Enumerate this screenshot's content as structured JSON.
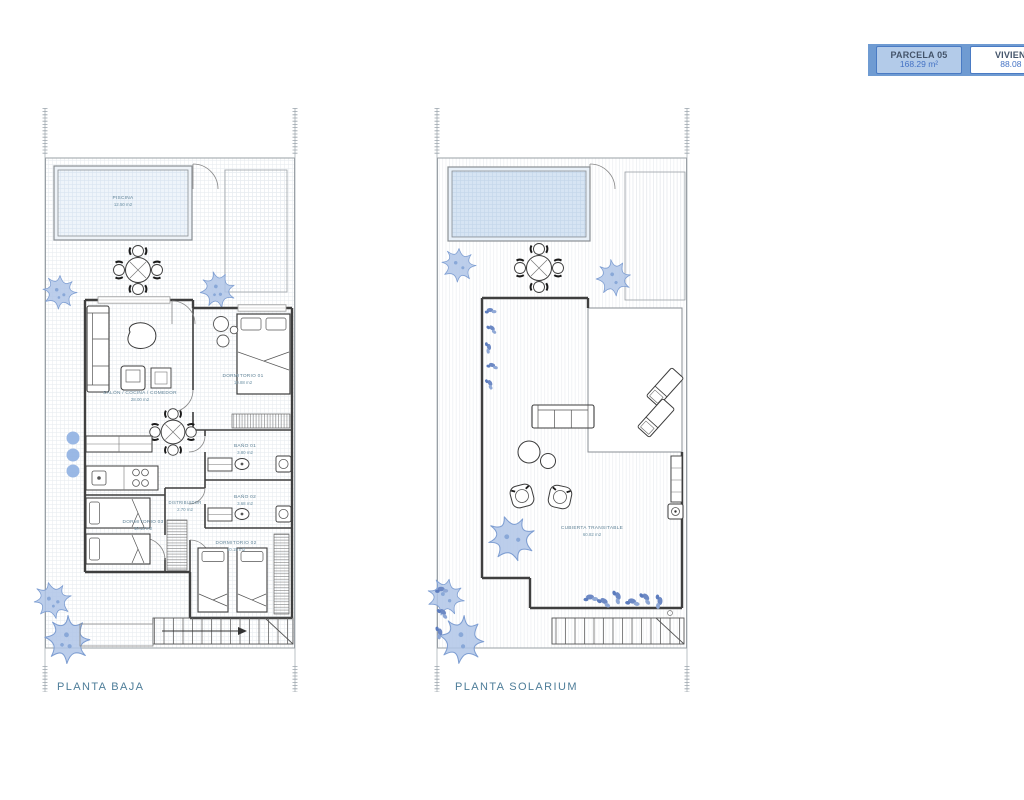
{
  "header": {
    "parcela": {
      "title": "PARCELA 05",
      "area": "168.29 m²"
    },
    "vivienda": {
      "title": "VIVIENDA",
      "area": "88.08 m²"
    }
  },
  "plans": {
    "baja": {
      "label": "PLANTA BAJA",
      "rooms": {
        "piscina": {
          "name": "PISCINA",
          "area": "12.50 m2"
        },
        "salon": {
          "name": "SALÓN / COCINA / COMEDOR",
          "area": "28.00 m2"
        },
        "dormitorio01": {
          "name": "DORMITORIO 01",
          "area": "10.88 m2"
        },
        "bano01": {
          "name": "BAÑO 01",
          "area": "3.80 m2"
        },
        "bano02": {
          "name": "BAÑO 02",
          "area": "3.68 m2"
        },
        "distribuidor": {
          "name": "DISTRIBUIDOR",
          "area": "2.70 m2"
        },
        "dormitorio03": {
          "name": "DORMITORIO 03",
          "area": "10.13 m2"
        },
        "dormitorio02": {
          "name": "DORMITORIO 02",
          "area": "10.15 m2"
        }
      }
    },
    "solarium": {
      "label": "PLANTA SOLARIUM",
      "rooms": {
        "cubierta": {
          "name": "CUBIERTA TRANSITABLE",
          "area": "60.82 m2"
        }
      }
    }
  },
  "colors": {
    "accent_blue": "#4472c4",
    "strip_fill": "#6f9bd2",
    "parcela_box_fill": "#b3cbe9",
    "room_label": "#5f8296",
    "plant_blue": "#b0c6e8",
    "pool_fill": "#d6e4f3",
    "wall": "#3f3f3f"
  }
}
